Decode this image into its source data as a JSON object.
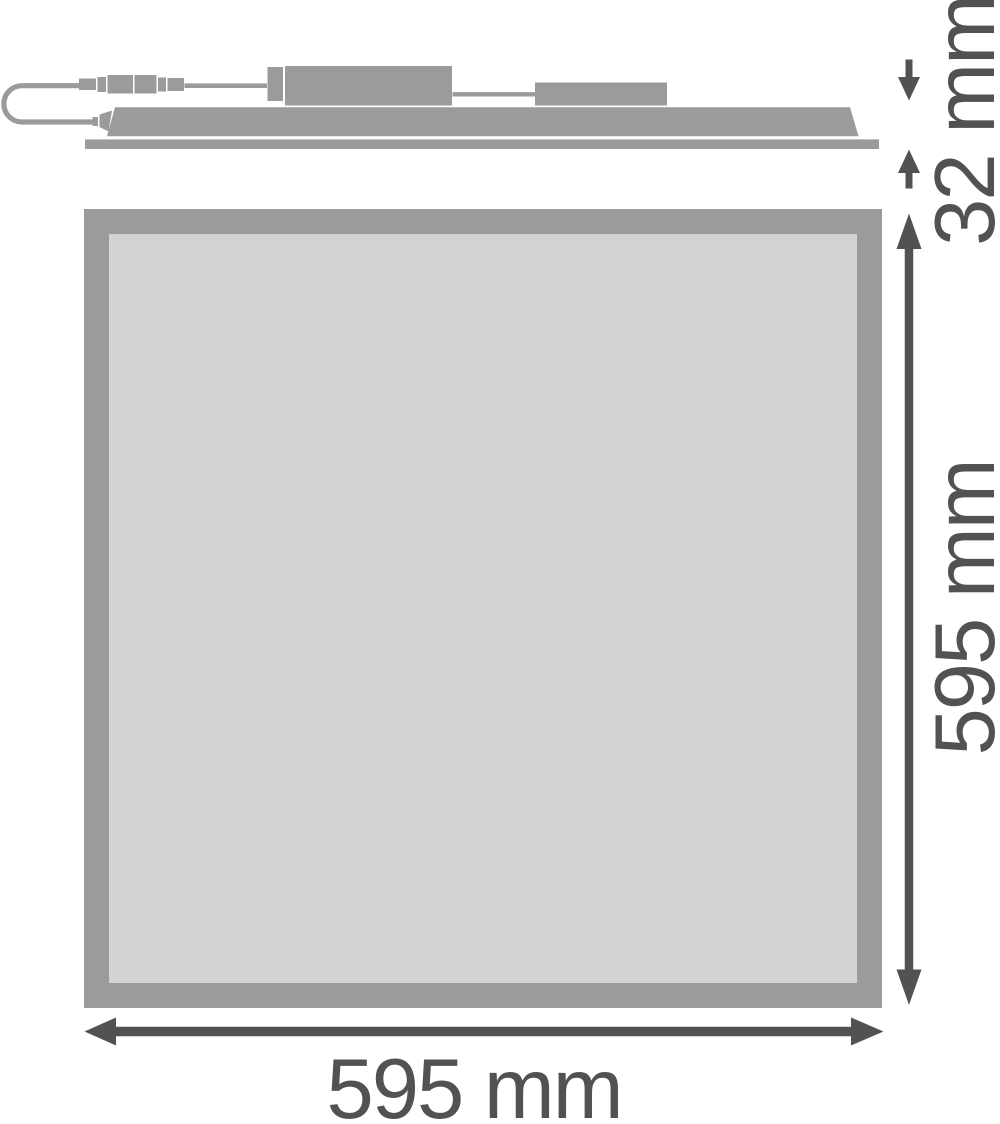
{
  "diagram": {
    "labels": {
      "profile_height": "32 mm",
      "panel_height": "595 mm",
      "panel_width": "595 mm"
    },
    "colors": {
      "background": "#ffffff",
      "product": "#9b9b9b",
      "panel_fill": "#d3d3d3",
      "dimension": "#545250"
    }
  }
}
